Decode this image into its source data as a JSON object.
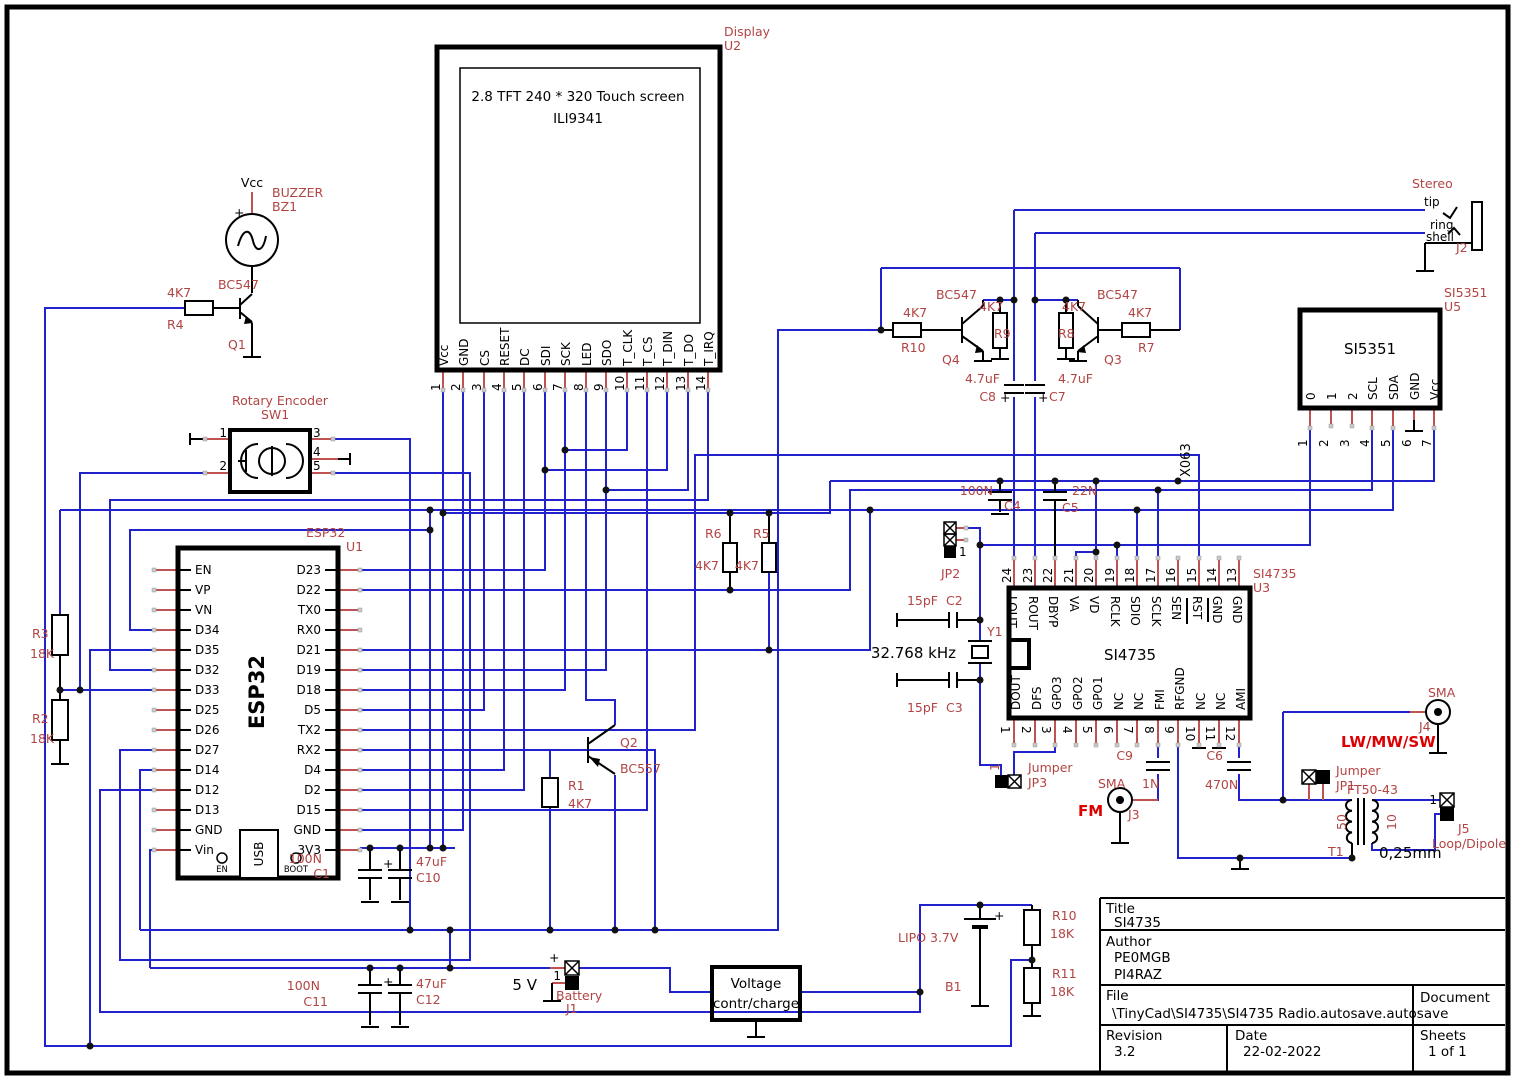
{
  "display": {
    "ref": "Display",
    "id": "U2",
    "title1": "2.8 TFT 240 * 320 Touch screen",
    "title2": "ILI9341",
    "pins": [
      {
        "n": "1",
        "name": "Vcc"
      },
      {
        "n": "2",
        "name": "GND"
      },
      {
        "n": "3",
        "name": "CS"
      },
      {
        "n": "4",
        "name": "RESET"
      },
      {
        "n": "5",
        "name": "DC"
      },
      {
        "n": "6",
        "name": "SDI"
      },
      {
        "n": "7",
        "name": "SCK"
      },
      {
        "n": "8",
        "name": "LED"
      },
      {
        "n": "9",
        "name": "SDO"
      },
      {
        "n": "10",
        "name": "T_CLK"
      },
      {
        "n": "11",
        "name": "T_CS"
      },
      {
        "n": "12",
        "name": "T_DIN"
      },
      {
        "n": "13",
        "name": "T_DO"
      },
      {
        "n": "14",
        "name": "T_IRQ"
      }
    ]
  },
  "esp32": {
    "ref": "ESP32",
    "id": "U1",
    "name": "ESP32",
    "usb": "USB",
    "en": "EN",
    "boot": "BOOT",
    "left": [
      "EN",
      "VP",
      "VN",
      "D34",
      "D35",
      "D32",
      "D33",
      "D25",
      "D26",
      "D27",
      "D14",
      "D12",
      "D13",
      "GND",
      "Vin"
    ],
    "right": [
      "D23",
      "D22",
      "TX0",
      "RX0",
      "D21",
      "D19",
      "D18",
      "D5",
      "TX2",
      "RX2",
      "D4",
      "D2",
      "D15",
      "GND",
      "3V3"
    ]
  },
  "si4735": {
    "ref": "SI4735",
    "id": "U3",
    "name": "SI4735",
    "top": [
      {
        "n": "24",
        "name": "LOUT"
      },
      {
        "n": "23",
        "name": "ROUT"
      },
      {
        "n": "22",
        "name": "DBYP"
      },
      {
        "n": "21",
        "name": "VA"
      },
      {
        "n": "20",
        "name": "VD"
      },
      {
        "n": "19",
        "name": "RCLK"
      },
      {
        "n": "18",
        "name": "SDIO"
      },
      {
        "n": "17",
        "name": "SCLK"
      },
      {
        "n": "16",
        "name": "SEN"
      },
      {
        "n": "15",
        "name": "RST"
      },
      {
        "n": "14",
        "name": "GND"
      },
      {
        "n": "13",
        "name": "GND"
      }
    ],
    "bottom": [
      {
        "n": "1",
        "name": "DOUT"
      },
      {
        "n": "2",
        "name": "DFS"
      },
      {
        "n": "3",
        "name": "GPO3"
      },
      {
        "n": "4",
        "name": "GPO2"
      },
      {
        "n": "5",
        "name": "GPO1"
      },
      {
        "n": "6",
        "name": "NC"
      },
      {
        "n": "7",
        "name": "NC"
      },
      {
        "n": "8",
        "name": "FMI"
      },
      {
        "n": "9",
        "name": "RFGND"
      },
      {
        "n": "10",
        "name": "NC"
      },
      {
        "n": "11",
        "name": "NC"
      },
      {
        "n": "12",
        "name": "AMI"
      }
    ]
  },
  "si5351": {
    "ref": "SI5351",
    "id": "U5",
    "name": "SI5351",
    "pins": [
      {
        "n": "1",
        "name": "0"
      },
      {
        "n": "2",
        "name": "1"
      },
      {
        "n": "3",
        "name": "2"
      },
      {
        "n": "4",
        "name": "SCL"
      },
      {
        "n": "5",
        "name": "SDA"
      },
      {
        "n": "6",
        "name": "GND"
      },
      {
        "n": "7",
        "name": "Vcc"
      }
    ]
  },
  "jack": {
    "label": "Stereo",
    "tip": "tip",
    "ring": "ring",
    "shell": "shell",
    "id": "J2"
  },
  "buzzer": {
    "vcc": "Vcc",
    "plus": "+",
    "label": "BUZZER",
    "id": "BZ1",
    "qt": "BC547",
    "q": "Q1",
    "rv": "4K7",
    "r": "R4"
  },
  "encoder": {
    "label": "Rotary Encoder",
    "id": "SW1",
    "p1": "1",
    "p2": "2",
    "p3": "3",
    "p4": "4",
    "p5": "5"
  },
  "div": {
    "r3": "R3",
    "r3v": "18K",
    "r2": "R2",
    "r2v": "18K"
  },
  "pull": {
    "r6": "R6",
    "r6v": "4K7",
    "r5": "R5",
    "r5v": "4K7"
  },
  "bl": {
    "q": "Q2",
    "qt": "BC557",
    "r": "R1",
    "rv": "4K7"
  },
  "mute": {
    "q4t": "BC547",
    "q3t": "BC547",
    "r10": "R10",
    "r10v": "4K7",
    "r9": "R9",
    "r9v": "4K7",
    "r8": "R8",
    "r8v": "4K7",
    "r7": "R7",
    "r7v": "4K7",
    "q4": "Q4",
    "q3": "Q3",
    "c8": "C8",
    "c8v": "4.7uF",
    "c7": "C7",
    "c7v": "4.7uF",
    "plus": "+"
  },
  "dec": {
    "c4": "C4",
    "c4v": "100N",
    "c5": "C5",
    "c5v": "22N",
    "x": "X063"
  },
  "xtal": {
    "c2": "C2",
    "c2v": "15pF",
    "c3": "C3",
    "c3v": "15pF",
    "y1": "Y1",
    "freq": "32.768 kHz"
  },
  "jp2": {
    "id": "JP2",
    "p1": "1"
  },
  "jp3": {
    "label": "Jumper",
    "id": "JP3",
    "p1": "1"
  },
  "j3": {
    "sma": "SMA",
    "net": "FM",
    "id": "J3"
  },
  "c9": {
    "id": "C9",
    "v": "1N"
  },
  "c6": {
    "id": "C6",
    "v": "470N"
  },
  "j4": {
    "sma": "SMA",
    "id": "J4",
    "net": "LW/MW/SW"
  },
  "jp1": {
    "label": "Jumper",
    "id": "JP1"
  },
  "t1": {
    "core": "FT50-43",
    "id": "T1",
    "prim": "50",
    "sec": "10",
    "wire": "0,25mm"
  },
  "j5": {
    "p1": "1",
    "id": "J5",
    "label": "Loop/Dipole"
  },
  "caps": {
    "c1": "C1",
    "c1v": "100N",
    "c10": "C10",
    "c10v": "47uF",
    "c11": "C11",
    "c11v": "100N",
    "c12": "C12",
    "c12v": "47uF",
    "plus": "+"
  },
  "pwr": {
    "v5": "5 V",
    "plus": "+",
    "p1": "1",
    "bat": "Battery",
    "batid": "J1",
    "vb1": "Voltage",
    "vb2": "contr/charge",
    "lipo": "LIPO 3.7V",
    "b1": "B1",
    "r10": "R10",
    "r10v": "18K",
    "r11": "R11",
    "r11v": "18K"
  },
  "tb": {
    "title_l": "Title",
    "title": "SI4735",
    "author_l": "Author",
    "a1": "PE0MGB",
    "a2": "PI4RAZ",
    "file_l": "File",
    "file": "\\TinyCad\\SI4735\\SI4735 Radio.autosave.autosave",
    "doc_l": "Document",
    "rev_l": "Revision",
    "rev": "3.2",
    "date_l": "Date",
    "date": "22-02-2022",
    "sheets_l": "Sheets",
    "sheets": "1 of 1"
  }
}
